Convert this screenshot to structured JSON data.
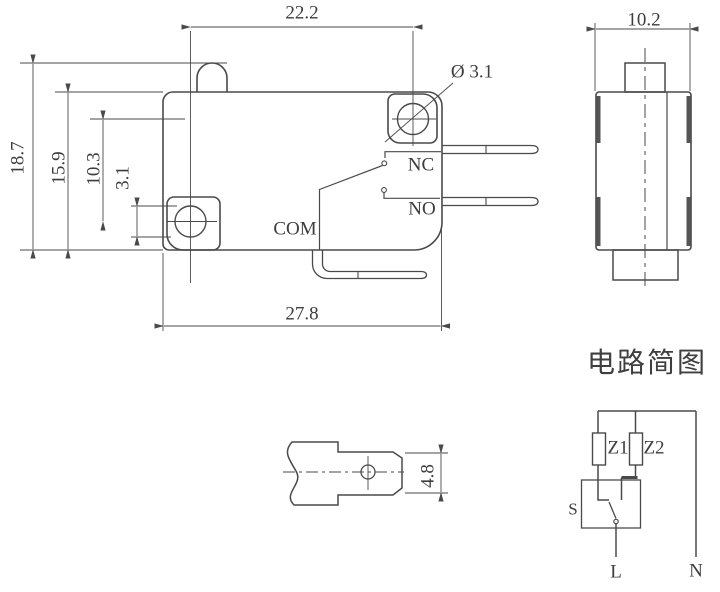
{
  "drawing": {
    "front_view": {
      "dim_hole_span_h": "22.2",
      "dim_height_total": "18.7",
      "dim_height_body": "15.9",
      "dim_hole_span_v": "10.3",
      "dim_hole_size": "3.1",
      "dim_hole_diameter": "Ø 3.1",
      "dim_width_body": "27.8",
      "label_nc": "NC",
      "label_no": "NO",
      "label_com": "COM"
    },
    "side_view": {
      "dim_width": "10.2"
    },
    "terminal_detail": {
      "dim_blade_height": "4.8"
    },
    "circuit": {
      "title": "电路简图",
      "label_z1": "Z1",
      "label_z2": "Z2",
      "label_switch": "S",
      "label_line": "L",
      "label_neutral": "N"
    },
    "colors": {
      "line": "#4a4a4a",
      "dim_line": "#555555",
      "background": "#ffffff"
    }
  }
}
